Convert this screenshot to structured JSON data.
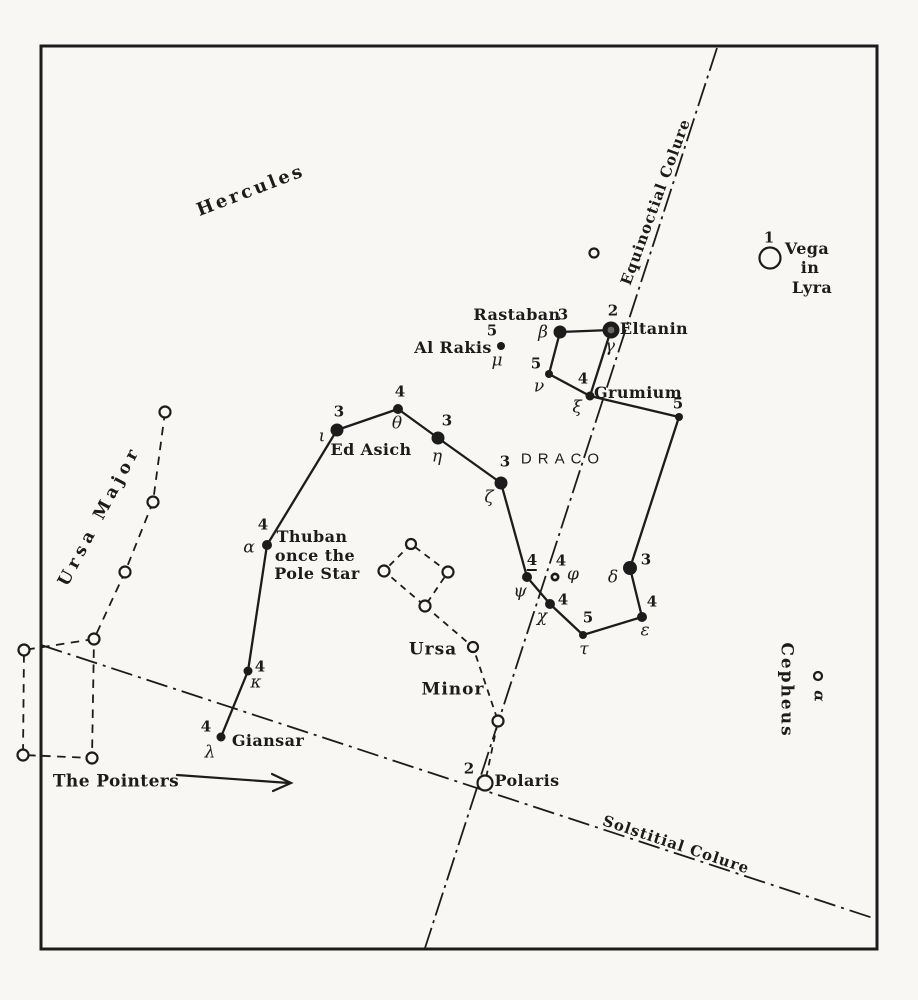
{
  "colors": {
    "ink": "#1c1c1c",
    "paper": "#f8f7f3"
  },
  "constellation_labels": {
    "hercules": "Hercules",
    "draco": "DRACO",
    "ursa_major": "Ursa Major",
    "ursa_minor_line1": "Ursa",
    "ursa_minor_line2": "Minor",
    "cepheus": "Cepheus",
    "cepheus_alpha_greek": "α"
  },
  "reference_lines": {
    "equinoctial": "Equinoctial Colure",
    "solstitial": "Solstitial Colure"
  },
  "pointers_label": "The Pointers",
  "stars": {
    "vega": {
      "magnitude": "1",
      "line1": "Vega",
      "line2": "in",
      "line3": "Lyra"
    },
    "polaris": {
      "magnitude": "2",
      "name": "Polaris"
    },
    "lambda": {
      "greek": "λ",
      "magnitude": "4",
      "name": "Giansar"
    },
    "kappa": {
      "greek": "κ",
      "magnitude": "4"
    },
    "alpha": {
      "greek": "α",
      "magnitude": "4",
      "name_line1": "Thuban",
      "name_line2": "once the",
      "name_line3": "Pole Star"
    },
    "iota": {
      "greek": "ι",
      "magnitude": "3",
      "name": "Ed Asich"
    },
    "theta": {
      "greek": "θ",
      "magnitude": "4"
    },
    "eta": {
      "greek": "η",
      "magnitude": "3"
    },
    "zeta": {
      "greek": "ζ",
      "magnitude": "3"
    },
    "psi": {
      "greek": "ψ",
      "magnitude": "4"
    },
    "chi": {
      "greek": "χ",
      "magnitude": "4"
    },
    "tau": {
      "greek": "τ",
      "magnitude": "5"
    },
    "epsilon": {
      "greek": "ε",
      "magnitude": "4"
    },
    "delta": {
      "greek": "δ",
      "magnitude": "3"
    },
    "node": {
      "magnitude": "5"
    },
    "xi": {
      "greek": "ξ",
      "magnitude": "4",
      "name": "Grumium"
    },
    "nu": {
      "greek": "ν",
      "magnitude": "5"
    },
    "beta": {
      "greek": "β",
      "magnitude": "3",
      "name": "Rastaban"
    },
    "gamma": {
      "greek": "γ",
      "magnitude": "2",
      "name": "Eltanin"
    },
    "mu": {
      "greek": "μ",
      "magnitude": "5",
      "name": "Al Rakis"
    },
    "phi": {
      "greek": "φ",
      "magnitude": "4"
    }
  }
}
